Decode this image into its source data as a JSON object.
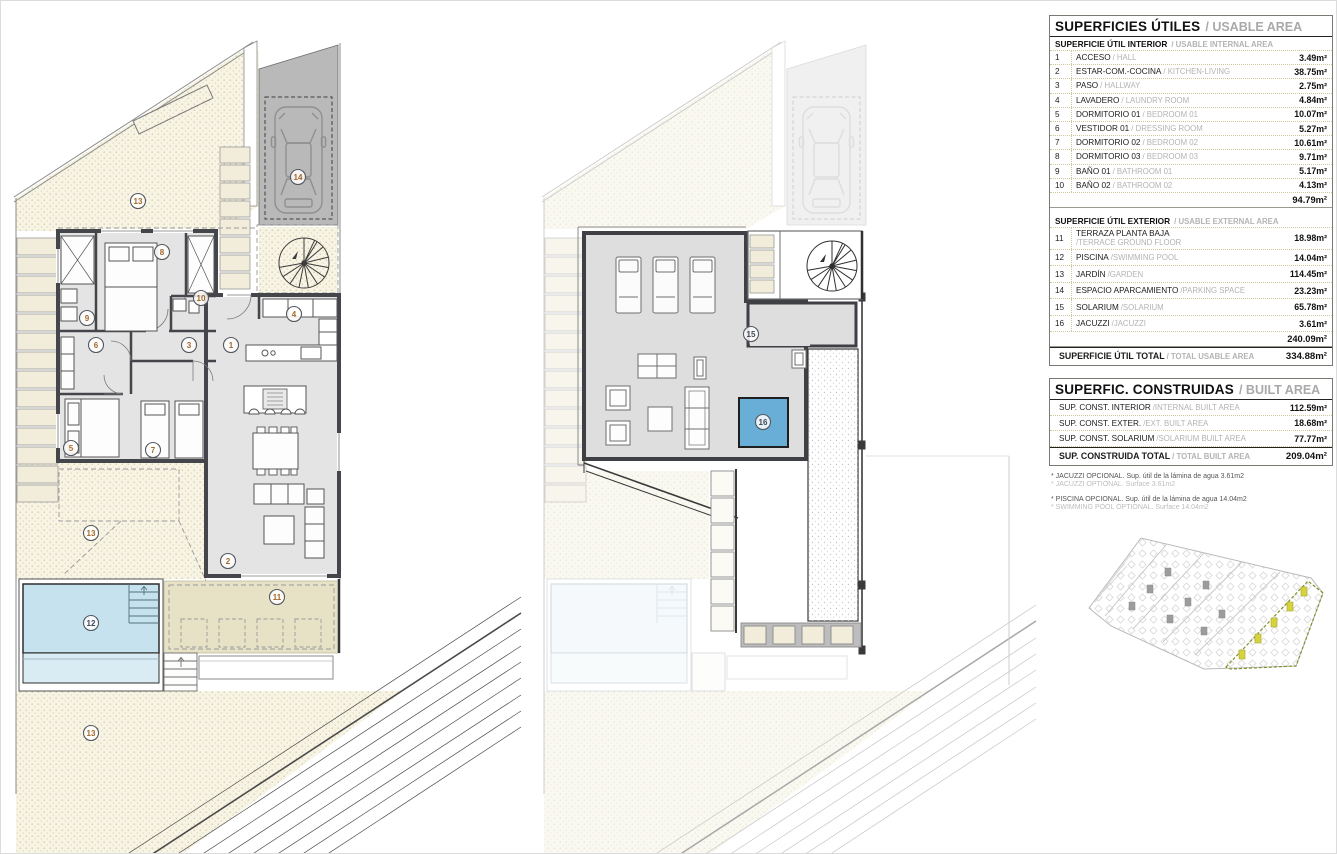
{
  "labels": {
    "n1": "1",
    "n2": "2",
    "n3": "3",
    "n4": "4",
    "n5": "5",
    "n6": "6",
    "n7": "7",
    "n8": "8",
    "n9": "9",
    "n10": "10",
    "n11": "11",
    "n12": "12",
    "n13": "13",
    "n14": "14",
    "n15": "15",
    "n16": "16"
  },
  "usable": {
    "title": "SUPERFICIES ÚTILES",
    "title_en": "/ USABLE AREA",
    "int_h": "SUPERFICIE ÚTIL INTERIOR",
    "int_h_en": "/ USABLE INTERNAL AREA",
    "rows_int": [
      {
        "n": "1",
        "es": "ACCESO",
        "en": "/ HALL",
        "a": "3.49m²"
      },
      {
        "n": "2",
        "es": "ESTAR-COM.-COCINA",
        "en": "/ KITCHEN-LIVING",
        "a": "38.75m²"
      },
      {
        "n": "3",
        "es": "PASO",
        "en": "/ HALLWAY",
        "a": "2.75m²"
      },
      {
        "n": "4",
        "es": "LAVADERO",
        "en": "/ LAUNDRY ROOM",
        "a": "4.84m²"
      },
      {
        "n": "5",
        "es": "DORMITORIO 01",
        "en": "/ BEDROOM 01",
        "a": "10.07m²"
      },
      {
        "n": "6",
        "es": "VESTIDOR 01",
        "en": "/ DRESSING ROOM",
        "a": "5.27m²"
      },
      {
        "n": "7",
        "es": "DORMITORIO 02",
        "en": "/ BEDROOM 02",
        "a": "10.61m²"
      },
      {
        "n": "8",
        "es": "DORMITORIO 03",
        "en": "/ BEDROOM 03",
        "a": "9.71m²"
      },
      {
        "n": "9",
        "es": "BAÑO 01",
        "en": "/ BATHROOM 01",
        "a": "5.17m²"
      },
      {
        "n": "10",
        "es": "BAÑO 02",
        "en": "/ BATHROOM 02",
        "a": "4.13m²"
      }
    ],
    "int_total": "94.79m²",
    "ext_h": "SUPERFICIE ÚTIL EXTERIOR",
    "ext_h_en": "/ USABLE EXTERNAL AREA",
    "rows_ext": [
      {
        "n": "11",
        "es": "TERRAZA PLANTA BAJA",
        "en": "/TERRACE GROUND FLOOR",
        "a": "18.98m²"
      },
      {
        "n": "12",
        "es": "PISCINA",
        "en": "/SWIMMING POOL",
        "a": "14.04m²"
      },
      {
        "n": "13",
        "es": "JARDÍN",
        "en": "/GARDEN",
        "a": "114.45m²"
      },
      {
        "n": "14",
        "es": "ESPACIO APARCAMIENTO",
        "en": "/PARKING SPACE",
        "a": "23.23m²"
      },
      {
        "n": "15",
        "es": "SOLARIUM",
        "en": "/SOLARIUM",
        "a": "65.78m²"
      },
      {
        "n": "16",
        "es": "JACUZZI",
        "en": "/JACUZZI",
        "a": "3.61m²"
      }
    ],
    "ext_total": "240.09m²",
    "total": "SUPERFICIE ÚTIL TOTAL",
    "total_en": "/ TOTAL USABLE AREA",
    "total_a": "334.88m²"
  },
  "built": {
    "title": "SUPERFIC. CONSTRUIDAS",
    "title_en": "/ BUILT AREA",
    "rows": [
      {
        "es": "SUP. CONST. INTERIOR",
        "en": "/INTERNAL BUILT AREA",
        "a": "112.59m²"
      },
      {
        "es": "SUP. CONST. EXTER.",
        "en": "/EXT. BUILT AREA",
        "a": "18.68m²"
      },
      {
        "es": "SUP. CONST. SOLARIUM",
        "en": "/SOLARIUM BUILT AREA",
        "a": "77.77m²"
      }
    ],
    "total": "SUP. CONSTRUIDA TOTAL",
    "total_en": "/ TOTAL BUILT AREA",
    "total_a": "209.04m²"
  },
  "notes": {
    "l1": "* JACUZZI OPCIONAL. Sup. útil de la lámina de agua 3.61m2",
    "l2": "* JACUZZI OPTIONAL. Surface 3.61m2",
    "l3": "* PISCINA OPCIONAL. Sup. útil de la lámina de agua 14.04m2",
    "l4": "* SWIMMING POOL OPTIONAL. Surface 14.04m2"
  }
}
